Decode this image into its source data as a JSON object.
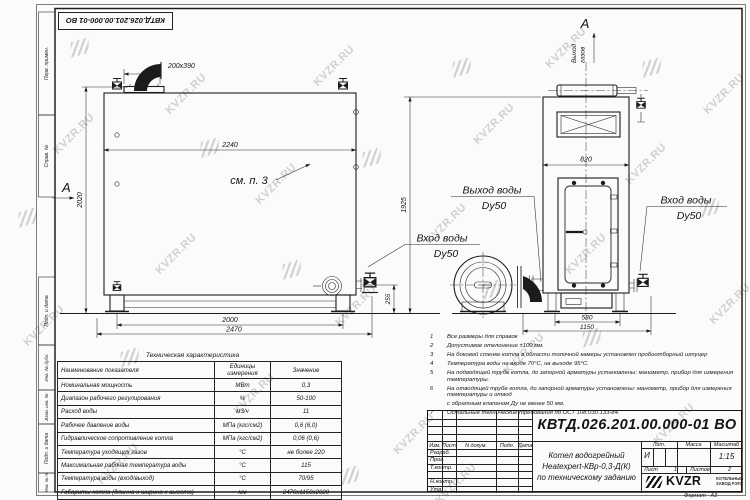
{
  "watermark": {
    "text": "KVZR.RU"
  },
  "colors": {
    "ink": "#1c1c1c",
    "watermark_gray": "#7d7d7d",
    "paper": "#fbfbf9"
  },
  "side_columns": [
    "Перв. примен.",
    "Справ. №",
    "Подп. и дата",
    "Инв. № дубл.",
    "Взам. инв. №",
    "Подп. и дата",
    "Инв. № подл."
  ],
  "labels": {
    "view_a": "А",
    "section_a": "А",
    "see_note": "см. п. 3",
    "gas_line1": "Выход",
    "gas_line2": "газов",
    "water_out1": "Выход воды",
    "water_out2": "Dy50",
    "water_in_left1": "Вход воды",
    "water_in_left2": "Dy50",
    "water_in_right1": "Вход воды",
    "water_in_right2": "Dy50"
  },
  "dims": {
    "flange": "200x390",
    "top_length": "2240",
    "side_height": "2020",
    "front_height": "1925",
    "front_width": "820",
    "inlet_height": "255",
    "leg_span": "2000",
    "overall_length": "2470",
    "front_span": "580",
    "front_overall": "1150"
  },
  "notes": {
    "items": [
      {
        "n": "1",
        "t": "Все размеры для справок"
      },
      {
        "n": "2",
        "t": "Допустимое отклонение ±100 мм."
      },
      {
        "n": "3",
        "t": "На боковой стенке котла в области топочной камеры установлен пробоотборный штуцер"
      },
      {
        "n": "4",
        "t": "Температура воды на входе 70°С, на выходе 95°С."
      },
      {
        "n": "5",
        "t": "На подводящей трубе котла, до запорной арматуры установлены: манометр, прибор для измерения температуры."
      },
      {
        "n": "6",
        "t": "На отводящей трубе котла, до запорной арматуры установлены: манометр, прибор для измерения температуры и отвод"
      },
      {
        "n": "",
        "t": "с обратным клапаном Ду не менее 50 мм."
      },
      {
        "n": "7",
        "t": "Остальные технические требования по ОСТ 108.030.133-84."
      }
    ]
  },
  "spec_table": {
    "title": "Техническая характеристика",
    "headers": [
      "Наименование показателя",
      "Единицы измерения",
      "Значение"
    ],
    "rows": [
      [
        "Номинальная мощность",
        "МВт",
        "0,3"
      ],
      [
        "Диапазон рабочего регулирования",
        "%",
        "50-100"
      ],
      [
        "Расход воды",
        "м3/ч",
        "11"
      ],
      [
        "Рабочее давление воды",
        "МПа (кгс/см2)",
        "0,6 (6,0)"
      ],
      [
        "Гидравлическое сопротивление котла",
        "МПа (кгс/см2)",
        "0,06 (0,6)"
      ],
      [
        "Температура уходящих газов",
        "°С",
        "не более 220"
      ],
      [
        "Максимальная рабочая температура воды",
        "°С",
        "115"
      ],
      [
        "Температура воды (вход/выход)",
        "°С",
        "70/95"
      ],
      [
        "Габариты котла (длинна х ширина х высота)",
        "мм",
        "2470х1150х2020"
      ]
    ]
  },
  "title_block": {
    "designation": "КВТД.026.201.00.000-01 ВО",
    "name_line1": "Котел водогрейный",
    "name_line2": "Heatexpert-КВр-0,3-Д(К)",
    "name_line3": "по техническому заданию",
    "rev_headers": [
      "Изм.",
      "Лист",
      "N докум.",
      "Подп.",
      "Дата"
    ],
    "sig_rows": [
      "Разраб.",
      "Пров.",
      "Т.контр.",
      "Н.контр.",
      "Утв."
    ],
    "lit_header": "Лит.",
    "mass_header": "Масса",
    "scale_header": "Масштаб",
    "lit_value": "И",
    "scale_value": "1:15",
    "sheet_label": "Лист",
    "sheet_value": "1",
    "sheets_label": "Листов",
    "sheets_value": "2",
    "logo_text": "KVZR",
    "logo_sub1": "КОТЕЛЬНЫЙ",
    "logo_sub2": "ЗАВОД РЭП",
    "format_label": "Формат",
    "format_value": "А3"
  }
}
